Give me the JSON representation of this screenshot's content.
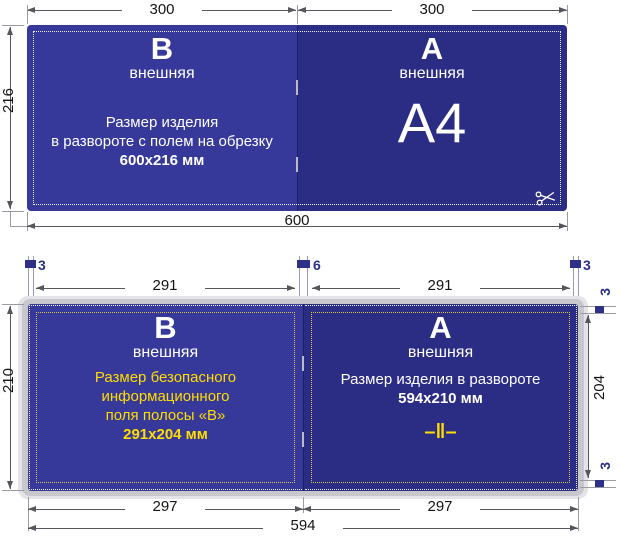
{
  "colors": {
    "panel_dark": "#2b2d84",
    "panel_light": "#37399a",
    "accent_yellow": "#ffdd00",
    "marker_blue": "#2d3087",
    "dim_line": "#55555c",
    "paper_gray": "#c7c7cd"
  },
  "icons": {
    "scissors": "✂"
  },
  "top_diagram": {
    "dim_left_width": "300",
    "dim_right_width": "300",
    "dim_height": "216",
    "dim_total_width": "600",
    "panel_b": {
      "letter": "В",
      "subtitle": "внешняя",
      "body": [
        "Размер изделия",
        "в развороте с полем на обрезку"
      ],
      "body_bold": "600х216 мм"
    },
    "panel_a": {
      "letter": "А",
      "subtitle": "внешняя",
      "format_label": "A4"
    }
  },
  "bottom_diagram": {
    "bleed_left": "3",
    "bleed_center": "6",
    "bleed_right": "3",
    "bleed_top_right": "3",
    "bleed_bottom_right": "3",
    "dim_safe_left": "291",
    "dim_safe_right": "291",
    "dim_height": "210",
    "dim_safe_height": "204",
    "dim_page_left": "297",
    "dim_page_right": "297",
    "dim_total_width": "594",
    "panel_b": {
      "letter": "В",
      "subtitle": "внешняя",
      "safe_lines": [
        "Размер безопасного",
        "информационного",
        "поля полосы «В»"
      ],
      "safe_bold": "291х204 мм"
    },
    "panel_a": {
      "letter": "А",
      "subtitle": "внешняя",
      "line": "Размер изделия в развороте",
      "line_bold": "594х210 мм",
      "fold_mark": "–‖–"
    }
  }
}
